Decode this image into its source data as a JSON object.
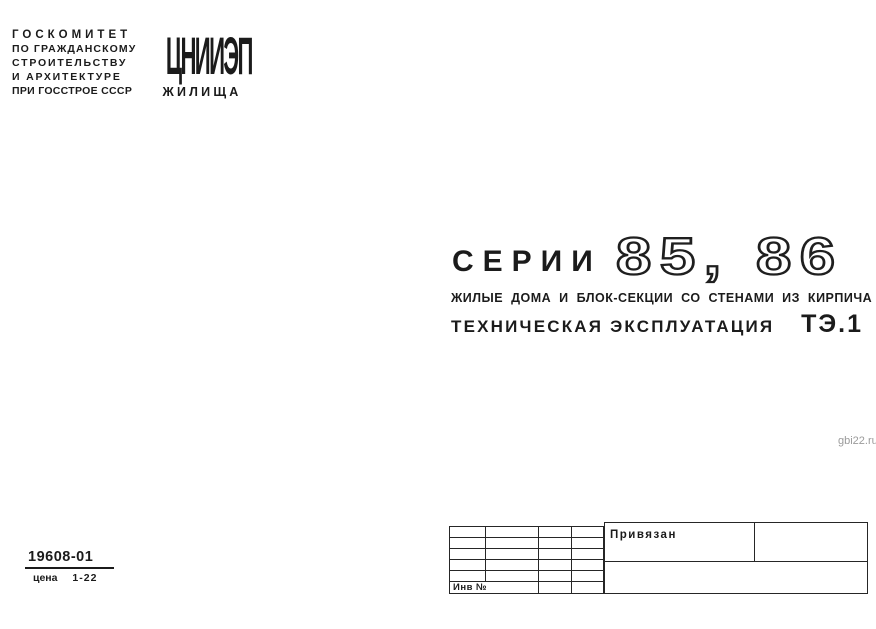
{
  "page": {
    "ink_color": "#1b1b1b",
    "background": "#ffffff"
  },
  "header": {
    "lines": [
      "ГОСКОМИТЕТ",
      "ПО ГРАЖДАНСКОМУ",
      "СТРОИТЕЛЬСТВУ",
      "И АРХИТЕКТУРЕ",
      "ПРИ ГОССТРОЕ СССР"
    ]
  },
  "logo": {
    "top": "ЦНИИЭП",
    "bottom": "ЖИЛИЩА"
  },
  "title": {
    "series_label": "СЕРИИ",
    "series_numbers": "85, 86",
    "subtitle": "ЖИЛЫЕ ДОМА И БЛОК-СЕКЦИИ СО СТЕНАМИ ИЗ КИРПИЧА",
    "doc_type": "ТЕХНИЧЕСКАЯ ЭКСПЛУАТАЦИЯ",
    "doc_code": "ТЭ.1"
  },
  "watermark": {
    "text": "gbi22.ru",
    "color": "#9b9b9b"
  },
  "catalog": {
    "number": "19608-01",
    "price_label": "цена",
    "price_value": "1-22"
  },
  "title_block": {
    "stamp_label": "Привязан",
    "inventory_label": "Инв №"
  }
}
